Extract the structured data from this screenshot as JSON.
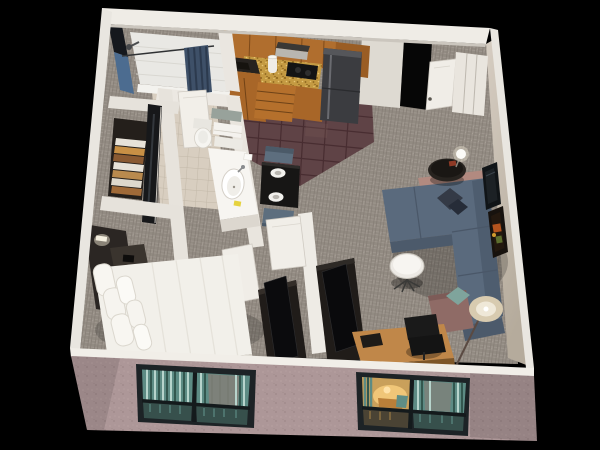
{
  "scene": {
    "title": "3D isometric cutaway floor plan rendering of a studio hotel suite",
    "view": "isometric cutaway from above, black background",
    "background": "#000000"
  },
  "palette": {
    "background": "#000000",
    "wall_white": "#efece6",
    "wall_inner_grey": "#dedad2",
    "wall_inner_beige": "#c6bdb2",
    "wall_exterior_pink": "#ad9798",
    "wall_accent_blue": "#4c6c90",
    "carpet_grey": "#9c948b",
    "kitchen_tile_plum": "#5f4346",
    "bathroom_tile_beige": "#d8cec0",
    "cabinet_wood": "#b06e2e",
    "backsplash_gold": "#c49a42",
    "fridge_steel": "#3b3c40",
    "sofa_blue": "#5a6a7d",
    "armchair_mauve": "#8f6b66",
    "pillow_teal": "#7fa49c",
    "pillow_dark": "#343a46",
    "bed_white": "#f2f0ea",
    "headboard_dark": "#2b2623",
    "furniture_dark": "#201c19",
    "desk_wood": "#c08749",
    "dining_table_black": "#171615",
    "dining_chair_blue": "#5d6e7e",
    "window_frame": "#1d2326",
    "window_glass_teal": "#5d8b84",
    "window_glow_warm": "#c9a05b",
    "lamp_shade_cream": "#d8cbb0",
    "shower_curtain_navy": "#3e5068",
    "vanity_white": "#f7f5f1",
    "soap_yellow": "#e6d23e"
  },
  "rooms": [
    {
      "id": "bathroom",
      "label": "Bathroom with tub shower"
    },
    {
      "id": "closet",
      "label": "Closet with mirrored door and linen shelves"
    },
    {
      "id": "vanity",
      "label": "Vanity alcove with sink and toilet"
    },
    {
      "id": "kitchen",
      "label": "Kitchenette"
    },
    {
      "id": "entry",
      "label": "Entry hall with door and closet"
    },
    {
      "id": "dining",
      "label": "Dining nook for two"
    },
    {
      "id": "bedroom",
      "label": "Bedroom area with queen bed"
    },
    {
      "id": "living",
      "label": "Living area with sectional sofa"
    }
  ],
  "furniture": {
    "bathroom": [
      "shower-tub",
      "shower-curtain",
      "shower-head",
      "toilet",
      "towel-shelf"
    ],
    "closet": [
      "mirrored-door",
      "linen-shelves"
    ],
    "vanity": [
      "vanity-counter",
      "sink",
      "faucet",
      "towels",
      "amenities"
    ],
    "kitchen": [
      "upper-cabinets",
      "range-hood",
      "backsplash",
      "cooktop",
      "paper-towel-roll",
      "sink-counter",
      "drawer-stack",
      "lower-cabinets",
      "refrigerator"
    ],
    "entry": [
      "entry-doorway",
      "entry-door",
      "entry-closet"
    ],
    "dining": [
      "dining-table",
      "place-settings",
      "dining-chair-upper",
      "dining-chair-lower"
    ],
    "bedroom": [
      "headboard",
      "wall-sconce",
      "nightstand",
      "bed",
      "pillows",
      "tv-dresser",
      "tv"
    ],
    "living": [
      "divider-wall",
      "divider-door",
      "media-console",
      "tv",
      "sectional-sofa",
      "chaise",
      "dark-pillow",
      "teal-pillow",
      "accent-armchair",
      "coffee-table",
      "side-table",
      "table-lamp",
      "floor-lamp",
      "desk",
      "office-chair",
      "wall-art"
    ]
  },
  "exterior": {
    "left_window": "2x2 paned window with teal striped curtains",
    "right_window": "2x2 paned window with teal curtains and warm lamp glow",
    "facade": "pink-mauve stucco lower wall, white wall caps"
  }
}
